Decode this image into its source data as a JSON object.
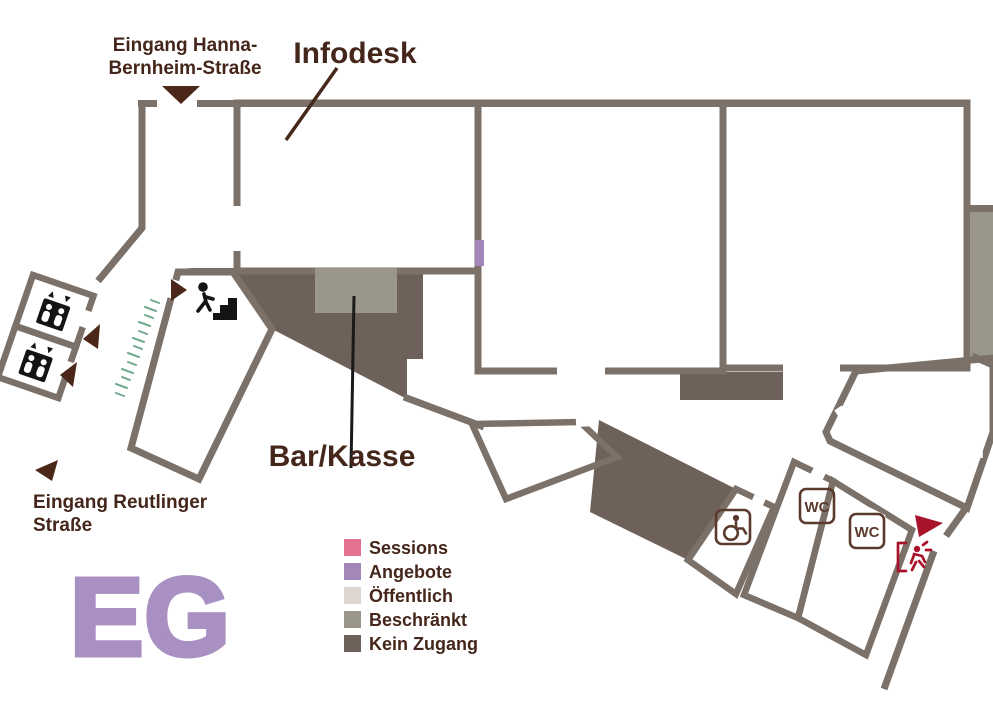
{
  "floor_label": "EG",
  "colors": {
    "sessions": "#e6718e",
    "angebote": "#a287b8",
    "oeffentlich": "#ddd5d0",
    "beschraenkt": "#9b968a",
    "kein_zugang": "#6e6159",
    "wall": "#7b7169",
    "text_brown": "#44261b",
    "pointer_brown": "#47291c",
    "pointer_black": "#1a1a1a",
    "arrow_brown": "#4a2718",
    "exit_red": "#a8122a",
    "grass_green": "#6faa8c",
    "eg_purple": "#a990c2",
    "icon_black": "#141414",
    "badge_brown": "#5a3a2c",
    "white": "#ffffff"
  },
  "entrances": {
    "hanna": {
      "line1": "Eingang Hanna-",
      "line2": "Bernheim-Straße"
    },
    "reutlinger": {
      "line1": "Eingang Reutlinger",
      "line2": "Straße"
    }
  },
  "annotations": {
    "infodesk": "Infodesk",
    "bar_kasse": "Bar/Kasse"
  },
  "rooms": {
    "foyer": "Foyer",
    "hackspace": "Hackspace",
    "buehne1": "Bühne 1",
    "kueche": "Küche",
    "elfenhain": "Elfenhain"
  },
  "badges": {
    "wc1": "WC",
    "wc2": "WC"
  },
  "icons": {
    "elevator": "elevator-icon",
    "stairs": "stairs-up-icon",
    "accessible_wc": "wheelchair-icon",
    "elf": "elf-icon",
    "emergency_exit": "emergency-exit-icon",
    "entrance_arrow": "entrance-arrow-icon"
  },
  "legend": {
    "items": [
      {
        "label": "Sessions"
      },
      {
        "label": "Angebote"
      },
      {
        "label": "Öffentlich"
      },
      {
        "label": "Beschränkt"
      },
      {
        "label": "Kein Zugang"
      }
    ]
  }
}
